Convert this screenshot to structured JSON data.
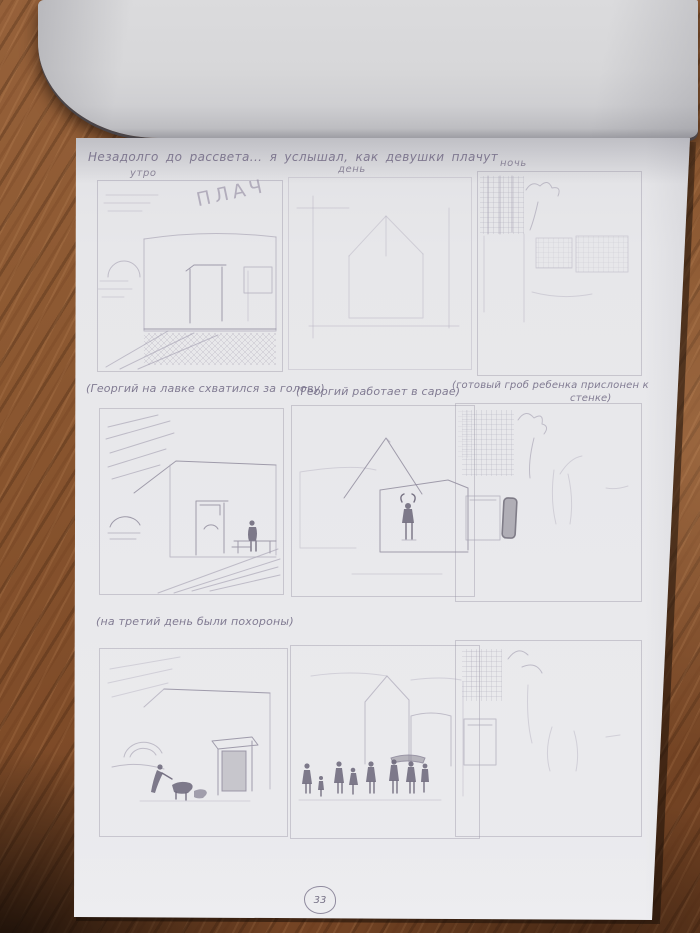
{
  "scene": {
    "description": "pencil storyboard page of a sketchbook photographed on a wooden desk",
    "palette": {
      "desk_wood": "#8a5630",
      "desk_shadow": "#241409",
      "paper": "#e8e8eb",
      "flipped_page": "#d4d4d7",
      "pencil_light": "#b7b3c1",
      "pencil_dark": "#716d7c"
    }
  },
  "header": {
    "caption": "Незадолго до рассвета... я услышал, как девушки плачут"
  },
  "storyboard": {
    "row1": {
      "panel1_label": "утро",
      "panel1_overlay": "ПЛАЧ",
      "panel2_label": "день",
      "panel3_label": "ночь"
    },
    "row2": {
      "caption_panel1": "(Георгий на лавке схватился за голову)",
      "caption_panel2": "(Георгий работает в сарае)",
      "caption_panel3_line1": "(готовый гроб ребенка прислонен к",
      "caption_panel3_line2": "стенке)"
    },
    "row3": {
      "caption": "(на третий день были похороны)"
    }
  },
  "footer": {
    "page_number": "33"
  }
}
